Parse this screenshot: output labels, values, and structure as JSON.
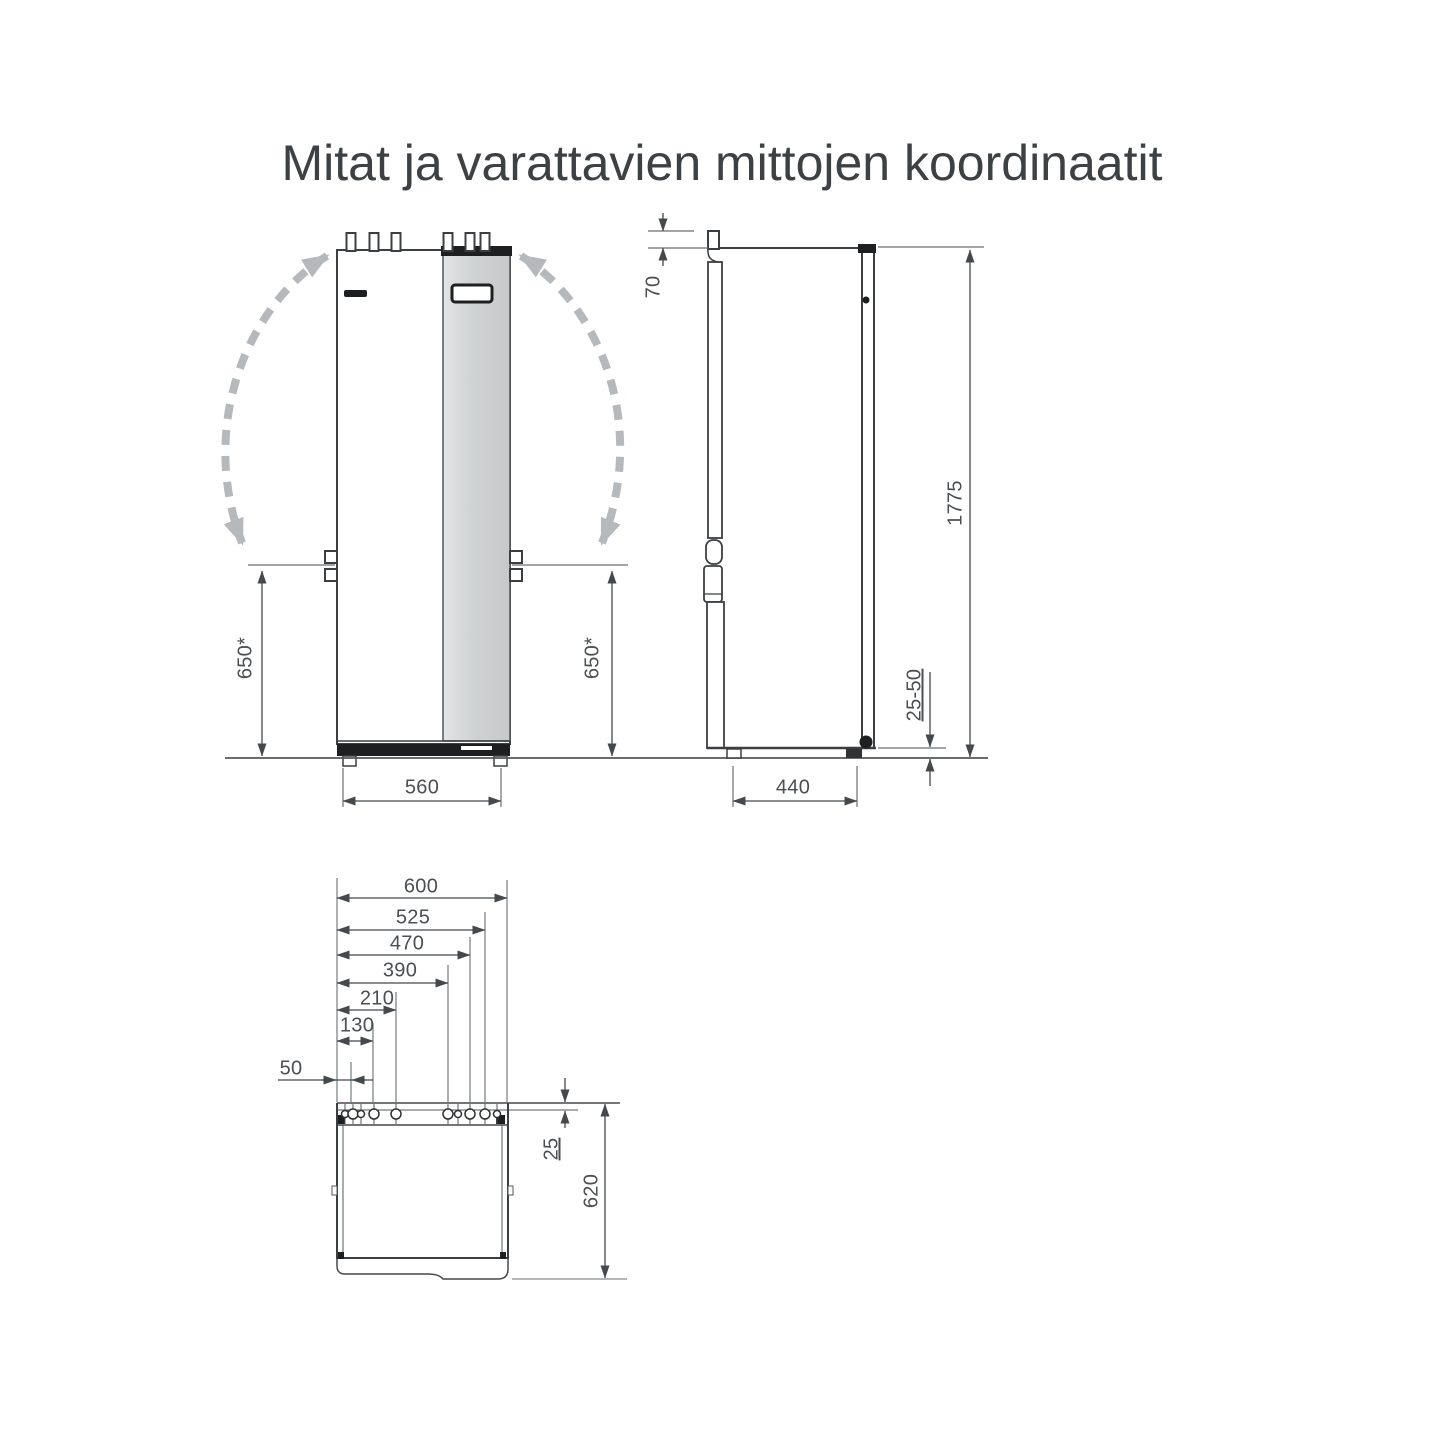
{
  "title": "Mitat ja varattavien mittojen koordinaatit",
  "front_view": {
    "height_left": "650*",
    "height_right": "650*",
    "width": "560"
  },
  "side_view": {
    "pipe_height": "70",
    "total_height": "1775",
    "foot_adjustment": "25-50",
    "depth": "440"
  },
  "top_view": {
    "width_total": "600",
    "pipe_offsets": {
      "p525": "525",
      "p470": "470",
      "p390": "390",
      "p210": "210",
      "p130": "130",
      "p50": "50"
    },
    "pipe_row_offset": "25",
    "depth_total": "620"
  }
}
